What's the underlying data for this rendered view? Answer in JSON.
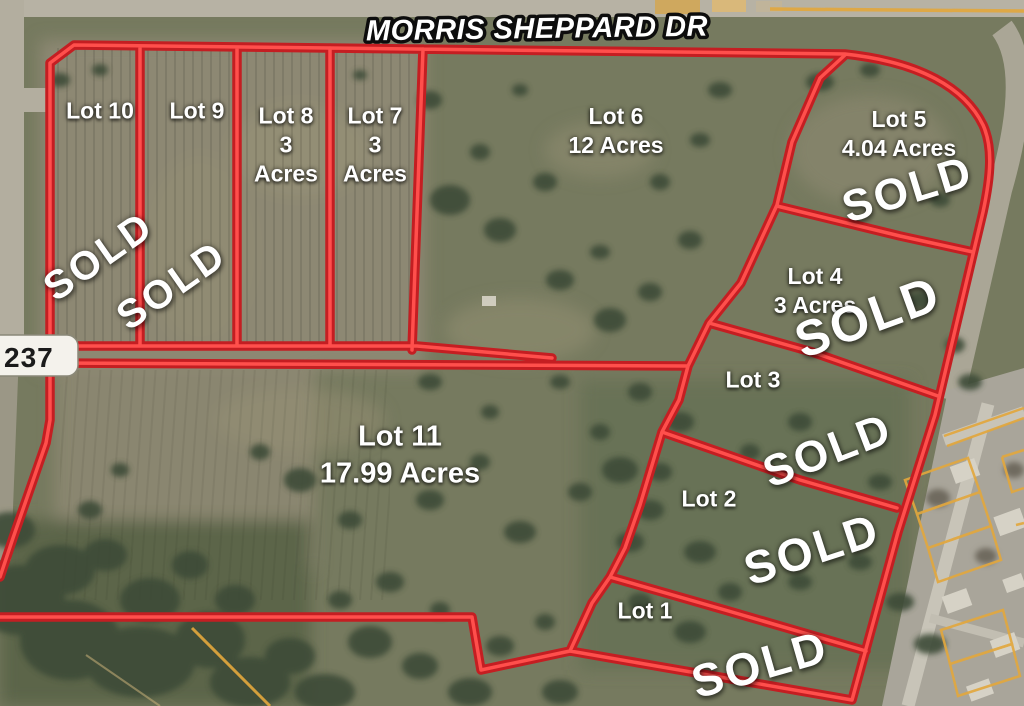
{
  "road_label": "MORRIS SHEPPARD DR",
  "route_marker": "237",
  "sold_text": "SOLD",
  "lots": {
    "lot1": {
      "name": "Lot 1",
      "sold": true
    },
    "lot2": {
      "name": "Lot 2",
      "sold": true
    },
    "lot3": {
      "name": "Lot 3",
      "sold": true
    },
    "lot4": {
      "name": "Lot 4",
      "acres": "3 Acres",
      "sold": true
    },
    "lot5": {
      "name": "Lot 5",
      "acres": "4.04 Acres",
      "sold": true
    },
    "lot6": {
      "name": "Lot 6",
      "acres": "12 Acres",
      "sold": false
    },
    "lot7": {
      "name": "Lot 7",
      "acres": "3\nAcres",
      "sold": false
    },
    "lot8": {
      "name": "Lot 8",
      "acres": "3\nAcres",
      "sold": false
    },
    "lot9": {
      "name": "Lot 9",
      "sold": true
    },
    "lot10": {
      "name": "Lot 10",
      "sold": true
    },
    "lot11": {
      "name": "Lot 11",
      "acres": "17.99 Acres",
      "sold": false
    }
  },
  "colors": {
    "boundary_red_dark": "#c41e22",
    "boundary_red_bright": "#ff4f4c",
    "parcel_line_yellow": "#e2a73e",
    "label_white": "#ffffff",
    "route_sign_bg": "#f4f2ec",
    "route_sign_text": "#1b1b1b"
  }
}
